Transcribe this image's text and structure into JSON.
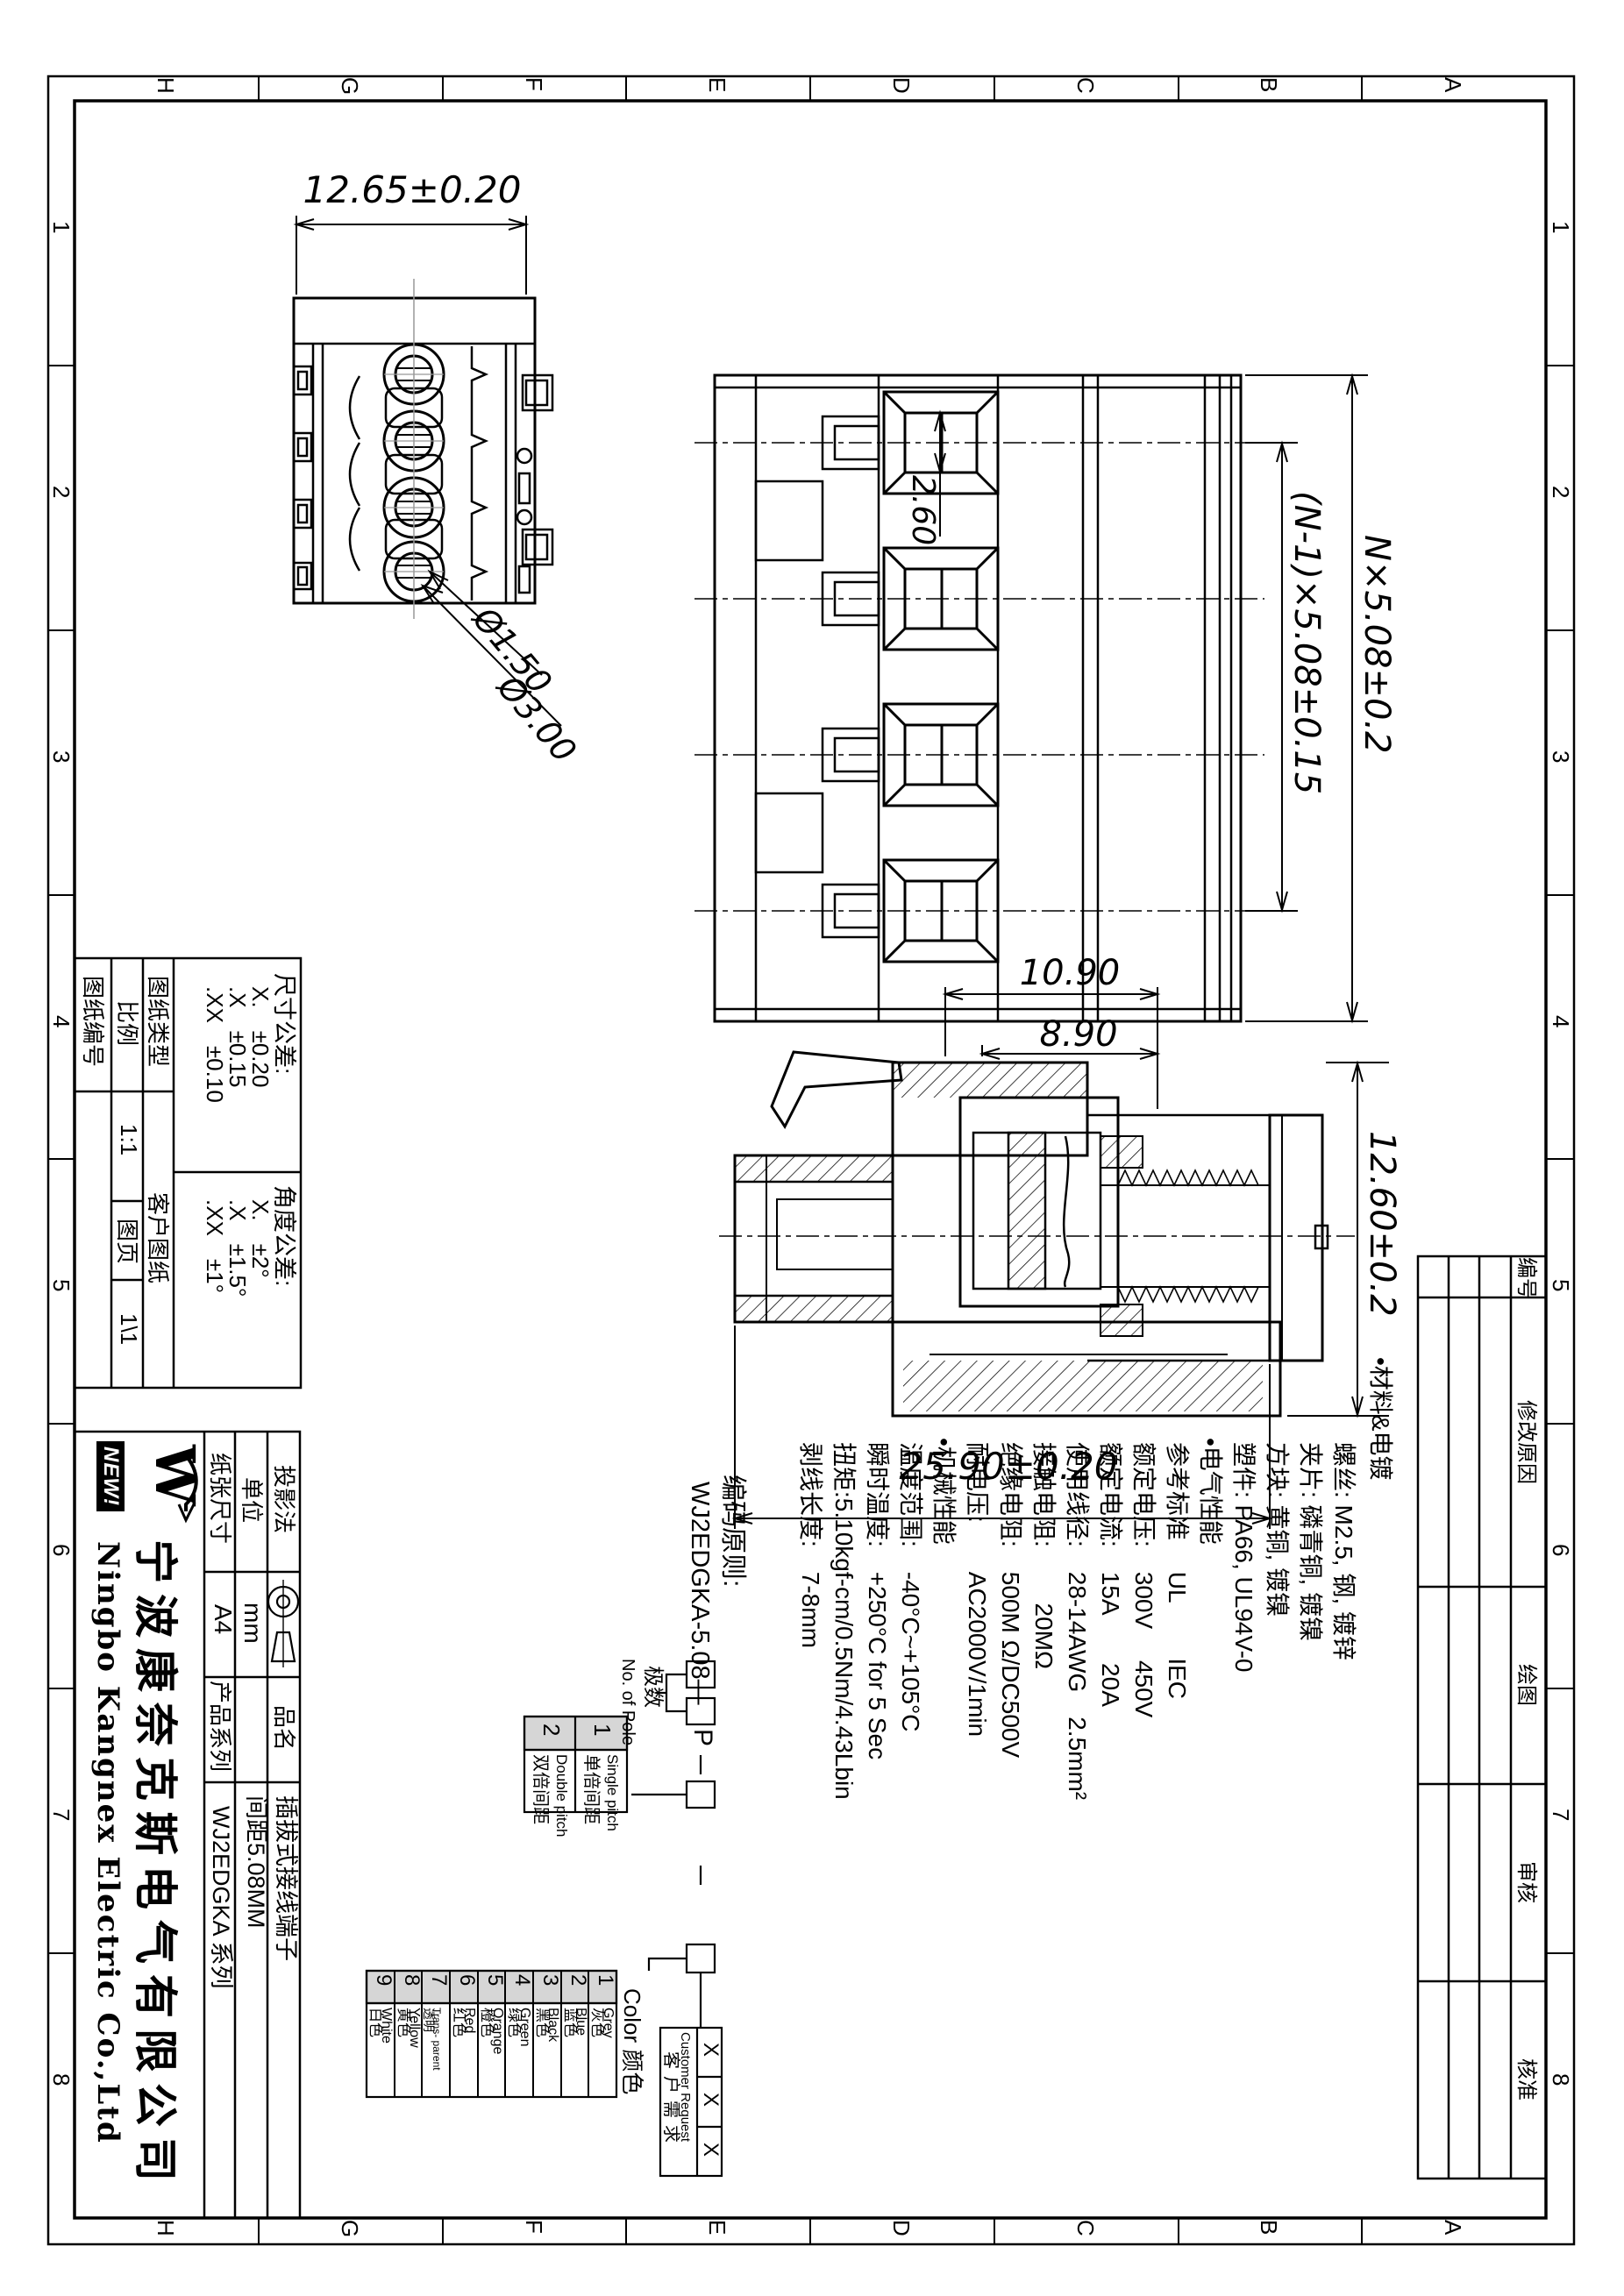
{
  "grid": {
    "letters": [
      "H",
      "G",
      "F",
      "E",
      "D",
      "C",
      "B",
      "A"
    ],
    "numbers": [
      "1",
      "2",
      "3",
      "4",
      "5",
      "6",
      "7",
      "8"
    ]
  },
  "views": {
    "top": {
      "width_dim": "12.65±0.20",
      "dia_small": "Ø1.50",
      "dia_big": "Ø3.00"
    },
    "front": {
      "window_dim": "2.60",
      "pitch_dim": "(N-1)×5.08±0.15",
      "total_dim": "N×5.08±0.2"
    },
    "section": {
      "dim_a": "10.90",
      "dim_b": "8.90",
      "dim_height": "12.60±0.2",
      "dim_length": "25.90±0.20"
    }
  },
  "specs": {
    "lines": [
      "•材料&电镀",
      "螺丝: M2.5, 钢, 镀锌",
      "夹片: 磷青铜, 镀镍",
      "方块: 黄铜, 镀镍",
      "塑件: PA66, UL94V-0",
      "•电气性能",
      "参考标准　 UL　　 IEC",
      "额定电压:　300V　 450V",
      "额定电流:　15A　　20A",
      "使用线径:　28-14AWG　2.5mm²",
      "接触电阻:　　 20MΩ",
      "绝缘电阻:　500M Ω/DC500V",
      "耐电压:　　AC2000V/1min",
      "•机械性能",
      "温度范围:　-40°C~+105°C",
      "瞬时温度:　+250°C for 5 Sec",
      "扭矩:5.10kgf-cm/0.5Nm/4.43Lbin",
      "剥线长度:　7-8mm"
    ]
  },
  "tolerance_table": {
    "drawing_no_label": "图纸编号",
    "scale_label": "比例",
    "scale_value": "1:1",
    "sheet_label": "图页",
    "sheet_value": "1\\1",
    "type_label": "图纸类型",
    "type_value": "客户图纸",
    "dim_header": "尺寸公差:",
    "dim_rows": [
      "X.　±0.20",
      ".X　±0.15",
      ".XX　±0.10"
    ],
    "angle_header": "角度公差:",
    "angle_rows": [
      "X.　±2°",
      ".X　±1.5°",
      ".XX　±1°"
    ]
  },
  "title_block": {
    "projection_label": "投影法",
    "unit_label": "单位",
    "unit_value": "mm",
    "paper_label": "纸张尺寸",
    "paper_value": "A4",
    "name_label": "品名",
    "name_line1": "插拔式接线端子",
    "name_line2": "间距5.08MM",
    "series_label": "产品系列",
    "series_value": "WJ2EDGKA 系列",
    "logo_letter": "W",
    "logo_badge": "NEW!",
    "company_cn": "宁波康奈克斯电气有限公司",
    "company_en": "Ningbo Kangnex Electric Co.,Ltd"
  },
  "ordering": {
    "title": "编码原则:",
    "code": "WJ2EDGKA-5.08—",
    "pole_suffix": "P",
    "pole_label_en": "No. of Pole",
    "pole_label_cn": "极数",
    "pitch": {
      "cols": [
        {
          "num": "1",
          "en": "Single pitch",
          "cn": "单倍间距"
        },
        {
          "num": "2",
          "en": "Double pitch",
          "cn": "双倍间距"
        }
      ]
    },
    "color_header": "Color 颜色",
    "colors": [
      {
        "num": "1",
        "en": "Grey",
        "cn": "灰色"
      },
      {
        "num": "2",
        "en": "Blue",
        "cn": "蓝色"
      },
      {
        "num": "3",
        "en": "Black",
        "cn": "黑色"
      },
      {
        "num": "4",
        "en": "Green",
        "cn": "绿色"
      },
      {
        "num": "5",
        "en": "Orange",
        "cn": "橙色"
      },
      {
        "num": "6",
        "en": "Red",
        "cn": "红色"
      },
      {
        "num": "7",
        "en": "Trans- parent",
        "cn": "透明"
      },
      {
        "num": "8",
        "en": "Yellow",
        "cn": "黄色"
      },
      {
        "num": "9",
        "en": "White",
        "cn": "白色"
      }
    ],
    "customer": {
      "en": "Customer Request",
      "cn": "客户需求",
      "x1": "X",
      "x2": "X",
      "x3": "X"
    }
  },
  "revision_table": {
    "headers": [
      "编号",
      "修改原因",
      "绘图",
      "审核",
      "核准"
    ]
  }
}
